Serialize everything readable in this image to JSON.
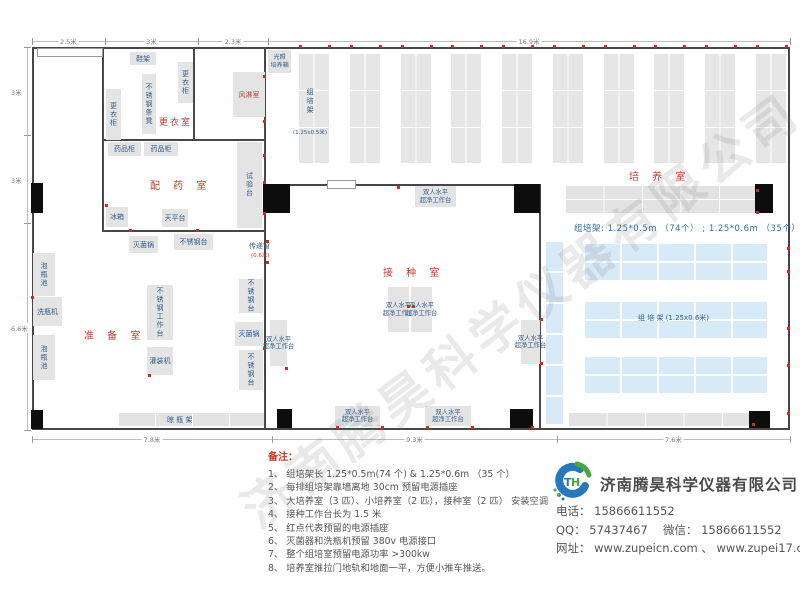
{
  "watermark": {
    "text": "济南腾昊科学仪器有限公司"
  },
  "notes": {
    "title": "备注：",
    "items": [
      "1、 组培架长 1.25*0.5m(74 个) & 1.25*0.6m （35 个）",
      "2、 每排组培架靠墙离地 30cm 预留电源插座",
      "3、 大培养室（3 匹）、小培养室（2 匹），接种室（2 匹） 安装空调",
      "4、 接种工作台长为 1.5 米",
      "5、 红点代表预留的电源插座",
      "6、 灭菌器和洗瓶机预留 380v 电源接口",
      "7、 整个组培室预留电源功率 >300kw",
      "8、 培养室推拉门地轨和地面一平，方便小推车推送。"
    ]
  },
  "company": {
    "name": "济南腾昊科学仪器有限公司",
    "contacts": [
      "电话： 15866611552",
      "QQ： 57437467　 微信： 15866611552",
      "网址： www.zupeicn.com 、 www.zupei17.com"
    ]
  },
  "floorplan": {
    "walls": [
      {
        "x": 32,
        "y": 47,
        "w": 758,
        "h": 2
      },
      {
        "x": 32,
        "y": 428,
        "w": 758,
        "h": 2
      },
      {
        "x": 32,
        "y": 47,
        "w": 2,
        "h": 383
      },
      {
        "x": 788,
        "y": 47,
        "w": 2,
        "h": 383
      },
      {
        "x": 102,
        "y": 47,
        "w": 2,
        "h": 185
      },
      {
        "x": 193,
        "y": 47,
        "w": 2,
        "h": 94
      },
      {
        "x": 103,
        "y": 139,
        "w": 162,
        "h": 2
      },
      {
        "x": 264,
        "y": 47,
        "w": 2,
        "h": 383
      },
      {
        "x": 264,
        "y": 184,
        "w": 277,
        "h": 2
      },
      {
        "x": 539,
        "y": 184,
        "w": 2,
        "h": 246
      },
      {
        "x": 103,
        "y": 230,
        "w": 162,
        "h": 2
      }
    ],
    "doors": [
      {
        "x": 37,
        "y": 48,
        "w": 66,
        "h": 9
      },
      {
        "x": 327,
        "y": 180,
        "w": 29,
        "h": 9
      }
    ],
    "pillars": [
      {
        "x": 31,
        "y": 183,
        "w": 12,
        "h": 30
      },
      {
        "x": 263,
        "y": 184,
        "w": 27,
        "h": 29
      },
      {
        "x": 514,
        "y": 184,
        "w": 26,
        "h": 29
      },
      {
        "x": 755,
        "y": 184,
        "w": 18,
        "h": 29
      },
      {
        "x": 31,
        "y": 410,
        "w": 12,
        "h": 19
      },
      {
        "x": 277,
        "y": 409,
        "w": 15,
        "h": 19
      },
      {
        "x": 510,
        "y": 409,
        "w": 23,
        "h": 19
      },
      {
        "x": 749,
        "y": 411,
        "w": 21,
        "h": 17
      }
    ],
    "furniture": [
      {
        "name": "shoe-rack",
        "label": "鞋架",
        "x": 130,
        "y": 52,
        "w": 26,
        "h": 13,
        "t": "h"
      },
      {
        "name": "locker-right",
        "label": "更衣柜",
        "x": 178,
        "y": 62,
        "w": 15,
        "h": 41,
        "t": "v"
      },
      {
        "name": "stainless-bench",
        "label": "不锈钢条凳",
        "x": 142,
        "y": 74,
        "w": 14,
        "h": 60,
        "t": "v"
      },
      {
        "name": "locker-left",
        "label": "更衣柜",
        "x": 106,
        "y": 89,
        "w": 15,
        "h": 51,
        "t": "v"
      },
      {
        "name": "air-shower",
        "label": "风淋室",
        "x": 233,
        "y": 72,
        "w": 32,
        "h": 45,
        "t": "h",
        "red": true
      },
      {
        "name": "light-incubator",
        "label": "光照\n培养箱",
        "x": 268,
        "y": 50,
        "w": 23,
        "h": 23,
        "t": "h2"
      },
      {
        "name": "medicine-cabinet-1",
        "label": "药品柜",
        "x": 108,
        "y": 142,
        "w": 33,
        "h": 14,
        "t": "h"
      },
      {
        "name": "medicine-cabinet-2",
        "label": "药品柜",
        "x": 144,
        "y": 142,
        "w": 34,
        "h": 14,
        "t": "h"
      },
      {
        "name": "test-bench",
        "label": "试验台",
        "x": 237,
        "y": 142,
        "w": 25,
        "h": 86,
        "t": "v"
      },
      {
        "name": "fridge",
        "label": "冰箱",
        "x": 106,
        "y": 207,
        "w": 22,
        "h": 20,
        "t": "h"
      },
      {
        "name": "balance-table",
        "label": "天平台",
        "x": 162,
        "y": 209,
        "w": 26,
        "h": 18,
        "t": "h"
      },
      {
        "name": "sterilizer-1",
        "label": "灭菌锅",
        "x": 129,
        "y": 236,
        "w": 29,
        "h": 17,
        "t": "h"
      },
      {
        "name": "stainless-table-1",
        "label": "不锈钢台",
        "x": 174,
        "y": 234,
        "w": 39,
        "h": 16,
        "t": "h"
      },
      {
        "name": "soak-pool-1",
        "label": "泡瓶池",
        "x": 33,
        "y": 253,
        "w": 22,
        "h": 43,
        "t": "v"
      },
      {
        "name": "bottle-washer",
        "label": "洗瓶机",
        "x": 33,
        "y": 297,
        "w": 29,
        "h": 29,
        "t": "h"
      },
      {
        "name": "soak-pool-2",
        "label": "泡瓶池",
        "x": 33,
        "y": 335,
        "w": 22,
        "h": 45,
        "t": "v"
      },
      {
        "name": "stainless-worktable",
        "label": "不锈钢工作台",
        "x": 147,
        "y": 285,
        "w": 26,
        "h": 55,
        "t": "v"
      },
      {
        "name": "filling-machine",
        "label": "灌装机",
        "x": 147,
        "y": 347,
        "w": 26,
        "h": 28,
        "t": "h"
      },
      {
        "name": "stainless-table-2",
        "label": "不锈钢台",
        "x": 239,
        "y": 279,
        "w": 24,
        "h": 34,
        "t": "v"
      },
      {
        "name": "sterilizer-2",
        "label": "灭菌锅",
        "x": 235,
        "y": 322,
        "w": 28,
        "h": 24,
        "t": "h"
      },
      {
        "name": "stainless-table-3",
        "label": "不锈钢台",
        "x": 239,
        "y": 350,
        "w": 24,
        "h": 40,
        "t": "v"
      },
      {
        "name": "laminar-bench-top",
        "label": "双人水平\n超净工作台",
        "x": 415,
        "y": 186,
        "w": 41,
        "h": 21,
        "t": "bench"
      },
      {
        "name": "laminar-bench-center-left",
        "label": "双人水平\n超净工作台",
        "x": 388,
        "y": 287,
        "w": 21,
        "h": 45,
        "t": "bench"
      },
      {
        "name": "laminar-bench-center-right",
        "label": "双人水平\n超净工作台",
        "x": 411,
        "y": 287,
        "w": 21,
        "h": 45,
        "t": "bench"
      },
      {
        "name": "laminar-bench-left",
        "label": "双人水平\n超净工作台",
        "x": 270,
        "y": 320,
        "w": 17,
        "h": 46,
        "t": "bench"
      },
      {
        "name": "laminar-bench-right",
        "label": "双人水平\n超净工作台",
        "x": 521,
        "y": 320,
        "w": 19,
        "h": 44,
        "t": "bench"
      },
      {
        "name": "laminar-bench-bottom-1",
        "label": "双人水平\n超净工作台",
        "x": 335,
        "y": 406,
        "w": 45,
        "h": 20,
        "t": "bench"
      },
      {
        "name": "laminar-bench-bottom-2",
        "label": "双人水平\n超净工作台",
        "x": 425,
        "y": 406,
        "w": 46,
        "h": 20,
        "t": "bench"
      }
    ],
    "racks": [
      {
        "type": "v",
        "xs": [
          298,
          349,
          400,
          450,
          501,
          552,
          603,
          653,
          704,
          755
        ],
        "y": 53,
        "w": 31,
        "h": 110,
        "name": "culture-rack-column"
      },
      {
        "type": "gh",
        "x": 565,
        "y": 185,
        "w": 191,
        "h": 28,
        "name": "culture-rack-row-top"
      },
      {
        "type": "gh",
        "x": 568,
        "y": 412,
        "w": 182,
        "h": 14,
        "name": "culture-rack-row-bottom"
      },
      {
        "type": "lh",
        "x": 118,
        "y": 413,
        "w": 148,
        "h": 13,
        "name": "bottle-drying-rack"
      },
      {
        "type": "bv",
        "x": 546,
        "y": 240,
        "w": 17,
        "h": 184,
        "name": "blue-rack-vertical"
      },
      {
        "type": "bh",
        "x": 583,
        "y": 242,
        "w": 184,
        "h": 38,
        "name": "blue-rack-row-1"
      },
      {
        "type": "bh",
        "x": 583,
        "y": 300,
        "w": 184,
        "h": 38,
        "name": "blue-rack-row-2"
      },
      {
        "type": "bh",
        "x": 583,
        "y": 355,
        "w": 184,
        "h": 38,
        "name": "blue-rack-row-3"
      }
    ],
    "labels": [
      {
        "n": "room-label-changing-room",
        "text": "更衣室",
        "x": 159,
        "y": 115,
        "cls": "room sm"
      },
      {
        "n": "room-label-dispensing-room",
        "text": "配 药 室",
        "x": 150,
        "y": 177,
        "cls": "room"
      },
      {
        "n": "room-label-prep-room",
        "text": "准 备 室",
        "x": 84,
        "y": 327,
        "cls": "room"
      },
      {
        "n": "room-label-inoculation-room",
        "text": "接 种 室",
        "x": 383,
        "y": 264,
        "cls": "room"
      },
      {
        "n": "room-label-culture-room",
        "text": "培 养 室",
        "x": 629,
        "y": 168,
        "cls": "room"
      },
      {
        "n": "transfer-window-label",
        "text": "传递窗",
        "x": 249,
        "y": 241,
        "cls": "blue-sm"
      },
      {
        "n": "transfer-window-size",
        "text": "(0.6米)",
        "x": 251,
        "y": 251,
        "cls": "red-tiny"
      },
      {
        "n": "drying-rack-label",
        "text": "晾  瓶  架",
        "x": 167,
        "y": 415,
        "cls": "blue-sm"
      },
      {
        "n": "rack-column-label",
        "text": "组培架",
        "x": 305,
        "y": 88,
        "cls": "vblue"
      },
      {
        "n": "rack-column-size",
        "text": "(1.25x0.5米)",
        "x": 293,
        "y": 128,
        "cls": "blue-tiny"
      },
      {
        "n": "blue-rack-label",
        "text": "组  培  架 (1.25x0.6米)",
        "x": 638,
        "y": 313,
        "cls": "blue-sm"
      },
      {
        "n": "culture-rack-info",
        "text": "组培架: 1.25*0.5m （74个） ; 1.25*0.6m （35个）",
        "x": 574,
        "y": 222,
        "cls": "blue-info"
      }
    ],
    "dots": [
      [
        299,
        45
      ],
      [
        328,
        45
      ],
      [
        350,
        45
      ],
      [
        379,
        45
      ],
      [
        401,
        45
      ],
      [
        430,
        45
      ],
      [
        451,
        45
      ],
      [
        480,
        45
      ],
      [
        502,
        45
      ],
      [
        531,
        45
      ],
      [
        553,
        45
      ],
      [
        582,
        45
      ],
      [
        604,
        45
      ],
      [
        633,
        45
      ],
      [
        654,
        45
      ],
      [
        683,
        45
      ],
      [
        705,
        45
      ],
      [
        734,
        45
      ],
      [
        756,
        45
      ],
      [
        785,
        45
      ],
      [
        263,
        75
      ],
      [
        263,
        120
      ],
      [
        263,
        154
      ],
      [
        263,
        181
      ],
      [
        263,
        212
      ],
      [
        105,
        204
      ],
      [
        129,
        229
      ],
      [
        196,
        229
      ],
      [
        31,
        296
      ],
      [
        148,
        374
      ],
      [
        263,
        347
      ],
      [
        266,
        240
      ],
      [
        266,
        261
      ],
      [
        397,
        186
      ],
      [
        407,
        305
      ],
      [
        412,
        305
      ],
      [
        285,
        367
      ],
      [
        540,
        318
      ],
      [
        540,
        362
      ],
      [
        336,
        426
      ],
      [
        381,
        426
      ],
      [
        426,
        426
      ],
      [
        471,
        426
      ],
      [
        531,
        426
      ],
      [
        756,
        189
      ],
      [
        756,
        211
      ],
      [
        787,
        247
      ],
      [
        787,
        270
      ],
      [
        787,
        327
      ],
      [
        787,
        364
      ],
      [
        787,
        412
      ],
      [
        752,
        423
      ]
    ],
    "dims": {
      "top": {
        "y": 41,
        "ticks": [
          32,
          105,
          198,
          268,
          790
        ],
        "labels": [
          "2.5米",
          "3米",
          "2.3米",
          "16.9米"
        ]
      },
      "bottom": {
        "y": 439,
        "ticks": [
          32,
          272,
          557,
          790
        ],
        "labels": [
          "7.8米",
          "9.3米",
          "7.6米"
        ]
      },
      "left": {
        "x": 27,
        "ticks": [
          47,
          135,
          223,
          430
        ],
        "labels": [
          "3米",
          "3米",
          "6.6米"
        ]
      }
    }
  }
}
